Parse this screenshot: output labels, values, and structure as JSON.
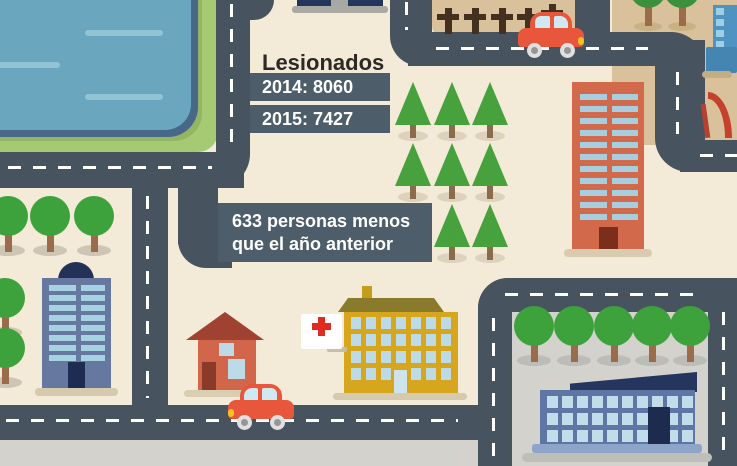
{
  "infographic": {
    "title": "Lesionados",
    "stats": [
      {
        "year": "2014",
        "value": "8060",
        "label": "2014: 8060"
      },
      {
        "year": "2015",
        "value": "7427",
        "label": "2015: 7427"
      }
    ],
    "note_line1": "633 personas menos",
    "note_line2": "que el año anterior",
    "difference": "633"
  },
  "colors": {
    "background": "#f3ead7",
    "road": "#475460",
    "info_box": "#4e5d6a",
    "grass": "#a6ca74",
    "water": "#6aa6be",
    "sand": "#d9c29b",
    "plaza": "#d3d2cd",
    "tree_green": "#3da23c",
    "pine_green": "#47a13d",
    "hospital_yellow": "#d7a61f",
    "tower_orange": "#d2694a",
    "building_blue": "#66789f",
    "car_red": "#e8563c",
    "cross_red": "#e02b20"
  }
}
